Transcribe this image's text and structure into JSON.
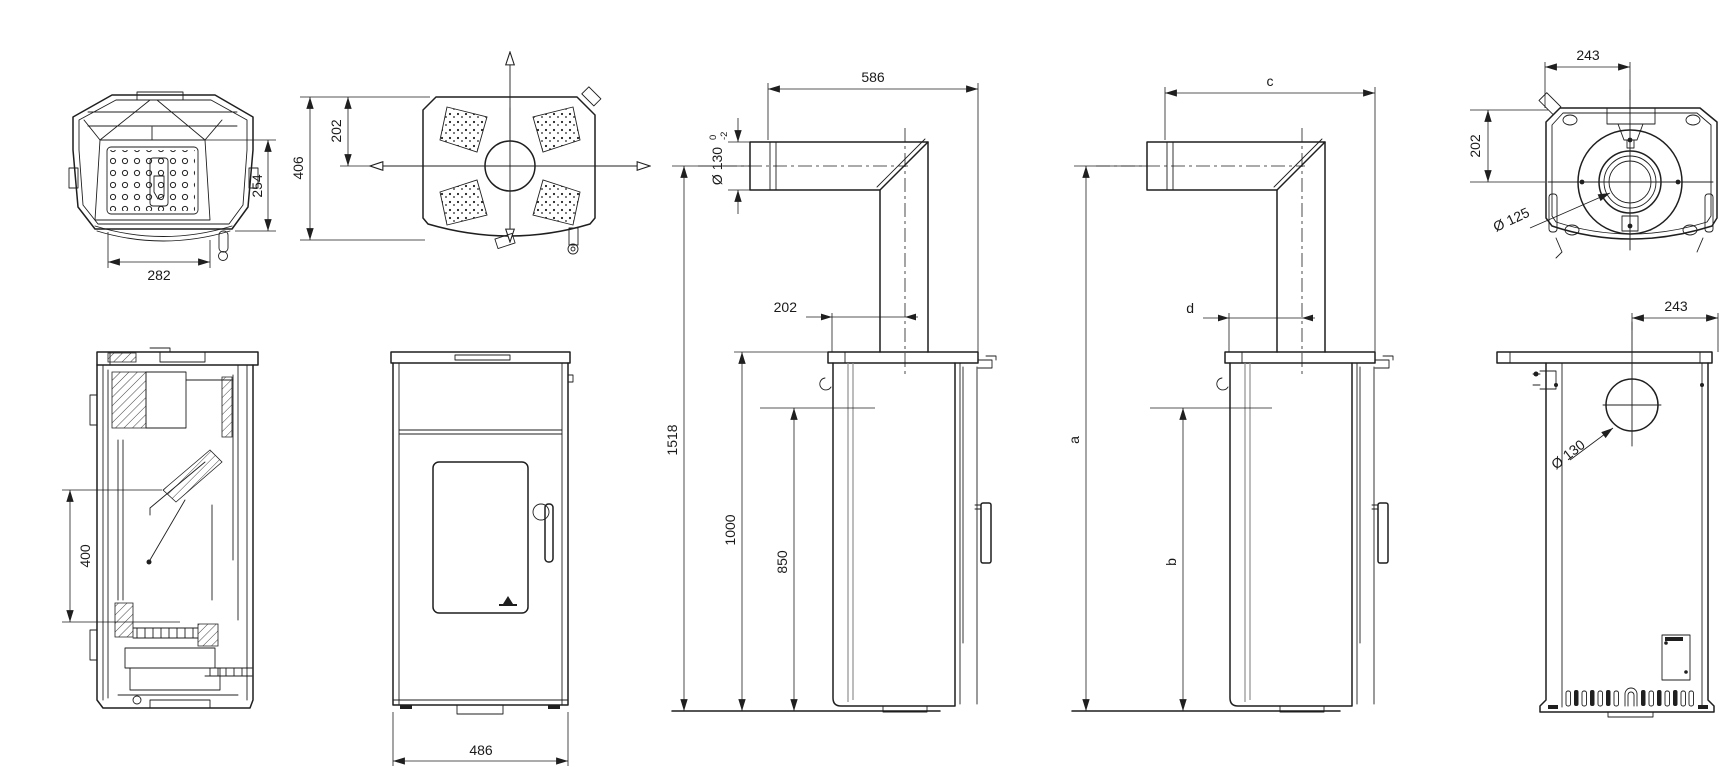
{
  "drawing": {
    "type": "technical-dimension-drawing",
    "subject": "pellet stove — multi-view dimensional drawing",
    "units": "mm",
    "line_color": "#1f1f1f",
    "background": "#ffffff"
  },
  "views": {
    "v1": {
      "name": "firebox-top-view",
      "dims": {
        "depth": "254",
        "width": "282"
      }
    },
    "v2": {
      "name": "top-view",
      "dims": {
        "depth": "406",
        "flue_offset": "202"
      }
    },
    "v3": {
      "name": "side-view-dimensioned",
      "dims": {
        "pipe_length": "586",
        "pipe_diameter": "Ø 130",
        "tol_upper": "0",
        "tol_lower": "-2",
        "flue_offset": "202",
        "height_total": "1518",
        "height_top": "1000",
        "height_rear_outlet": "850"
      }
    },
    "v4": {
      "name": "side-view-lettered",
      "dims": {
        "pipe_length": "c",
        "flue_offset": "d",
        "height_total": "a",
        "height_rear_outlet": "b"
      }
    },
    "v5": {
      "name": "bottom-view",
      "dims": {
        "width": "243",
        "depth": "202",
        "flue_diameter": "Ø 125"
      }
    },
    "v6": {
      "name": "back-view",
      "dims": {
        "width": "243",
        "flue_diameter": "Ø 130"
      }
    },
    "v7": {
      "name": "section-view",
      "dims": {
        "glass_height": "400"
      }
    },
    "v8": {
      "name": "front-view",
      "dims": {
        "width": "486"
      }
    }
  }
}
